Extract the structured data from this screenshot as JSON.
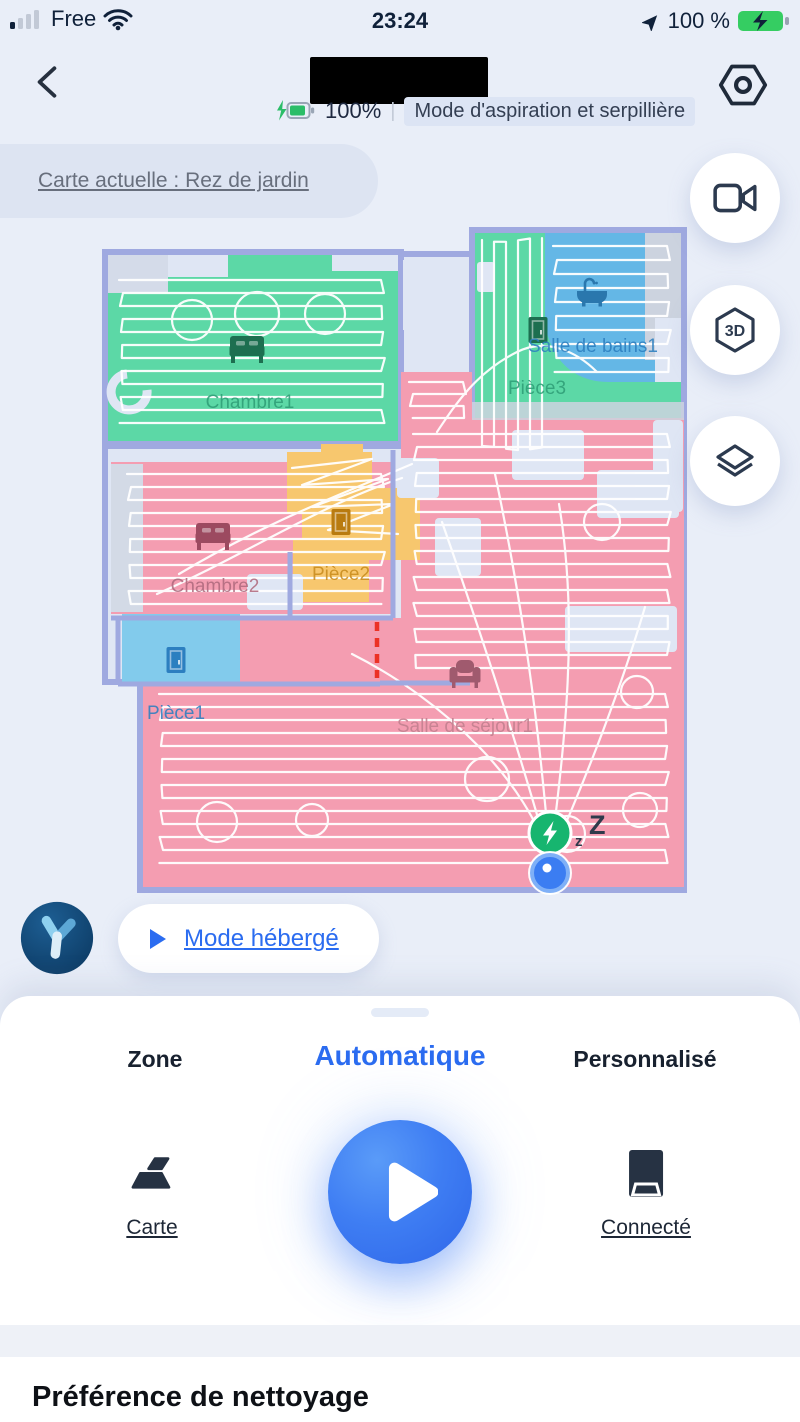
{
  "status_bar": {
    "carrier": "Free",
    "time": "23:24",
    "battery_percent": "100 %"
  },
  "header": {
    "battery_level": "100%",
    "separator": "|",
    "cleaning_mode": "Mode d'aspiration et serpillière"
  },
  "map_bar": {
    "current_map": "Carte actuelle : Rez de jardin"
  },
  "side_controls": {
    "video_icon": "video-camera",
    "three_d_label": "3D",
    "layers_icon": "layers"
  },
  "map": {
    "rooms": [
      {
        "name": "Chambre1",
        "color": "#5cd8a6",
        "label_color": "#2f9e77",
        "icon": "bed"
      },
      {
        "name": "Salle de bains1",
        "color": "#64b7e6",
        "label_color": "#2c7fc0",
        "icon": "bathtub"
      },
      {
        "name": "Pièce3",
        "color": "#5cd8a6",
        "label_color": "#2f9e77",
        "icon": "door"
      },
      {
        "name": "Chambre2",
        "color": "#f49db1",
        "label_color": "#b06a7e",
        "icon": "bed"
      },
      {
        "name": "Pièce2",
        "color": "#f7c76e",
        "label_color": "#c98c1e",
        "icon": "door"
      },
      {
        "name": "Pièce1",
        "color": "#82cbec",
        "label_color": "#2c7fc0",
        "icon": "door"
      },
      {
        "name": "Salle de séjour1",
        "color": "#f49db1",
        "label_color": "#c2808f",
        "icon": "sofa"
      }
    ],
    "sleep_small": "z",
    "sleep_big": "Z",
    "virtual_wall_color": "#ec3125",
    "wall_color": "#9fa9e0"
  },
  "host_bar": {
    "label": "Mode hébergé"
  },
  "sheet": {
    "tabs": [
      {
        "label": "Zone",
        "active": false
      },
      {
        "label": "Automatique",
        "active": true
      },
      {
        "label": "Personnalisé",
        "active": false
      }
    ],
    "map_action_label": "Carte",
    "dock_status_label": "Connecté"
  },
  "section": {
    "title": "Préférence de nettoyage"
  },
  "theme": {
    "accent_blue": "#2b6cf0",
    "battery_green": "#2bbd68"
  }
}
